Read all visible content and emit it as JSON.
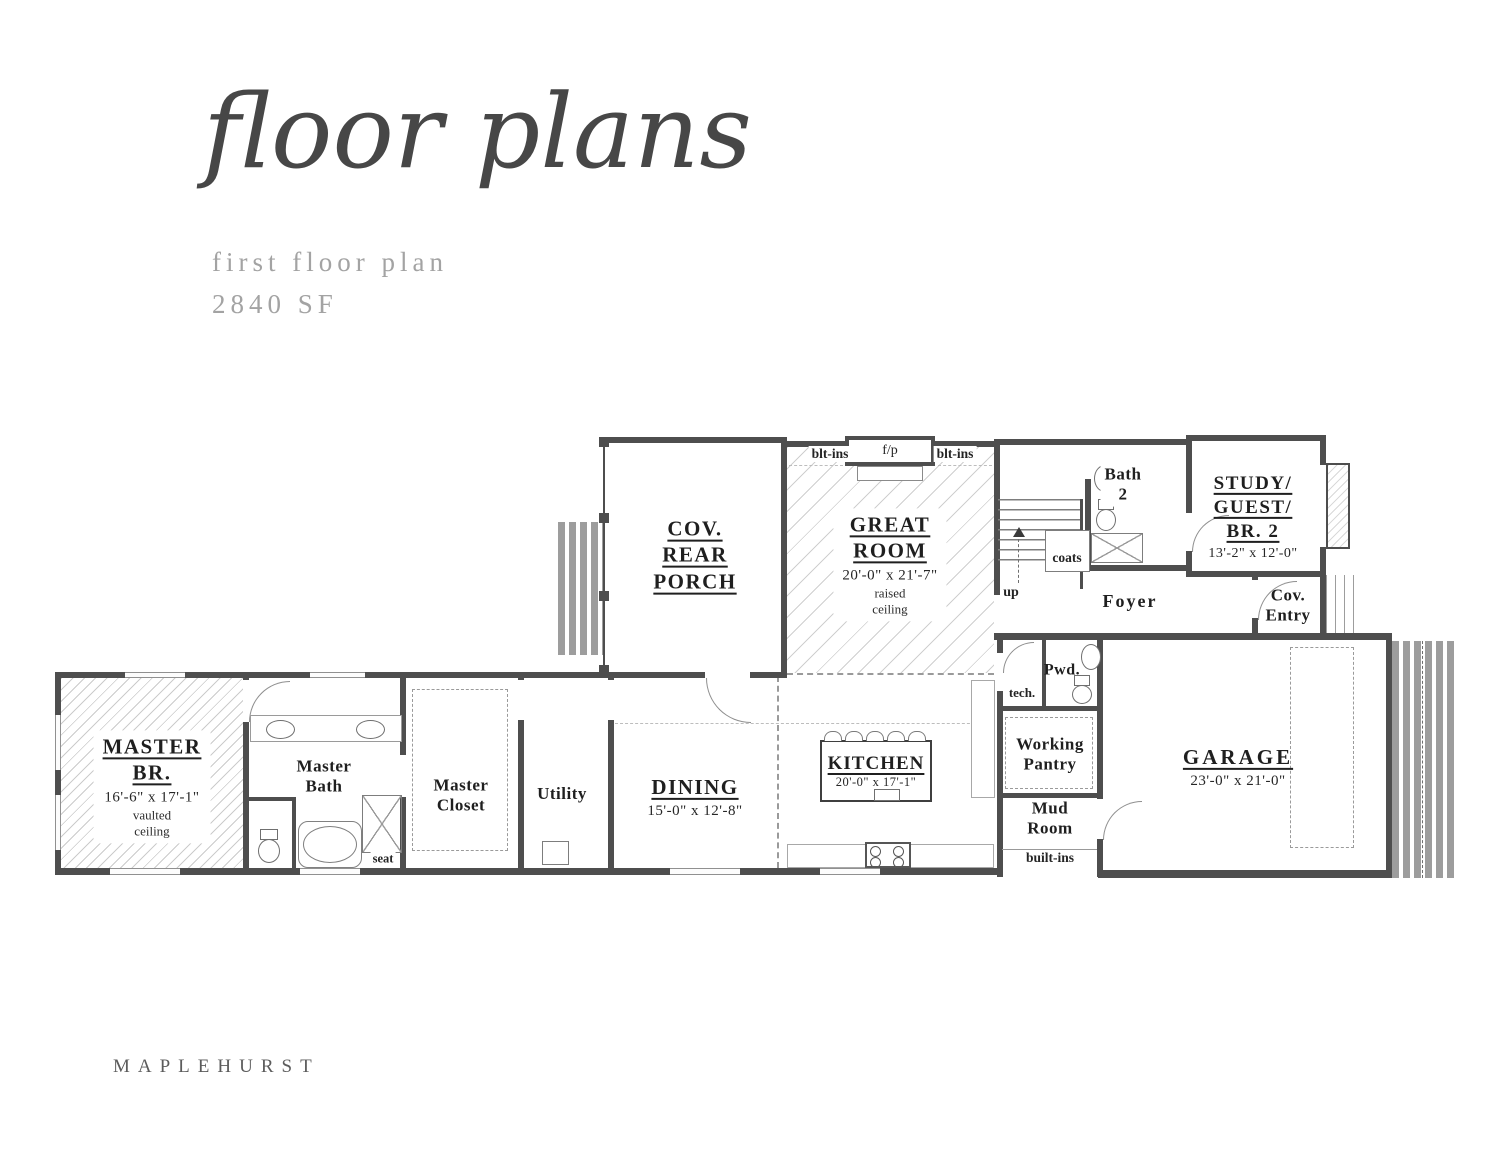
{
  "header": {
    "title": "floor plans",
    "subtitle": "first floor plan",
    "area": "2840 SF"
  },
  "footer": {
    "brand": "MAPLEHURST"
  },
  "rooms": {
    "master_br": {
      "name": "MASTER\nBR.",
      "dims": "16'-6\" x 17'-1\"",
      "note": "vaulted\nceiling"
    },
    "master_bath": {
      "name": "Master\nBath"
    },
    "master_closet": {
      "name": "Master\nCloset"
    },
    "utility": {
      "name": "Utility"
    },
    "dining": {
      "name": "DINING",
      "dims": "15'-0\" x 12'-8\""
    },
    "kitchen": {
      "name": "KITCHEN",
      "dims": "20'-0\" x 17'-1\""
    },
    "great_room": {
      "name": "GREAT\nROOM",
      "dims": "20'-0\" x 21'-7\"",
      "note": "raised\nceiling"
    },
    "cov_rear_porch": {
      "name": "COV.\nREAR\nPORCH"
    },
    "study": {
      "name": "STUDY/\nGUEST/\nBR. 2",
      "dims": "13'-2\" x 12'-0\""
    },
    "bath2": {
      "name": "Bath\n2"
    },
    "foyer": {
      "name": "Foyer"
    },
    "cov_entry": {
      "name": "Cov.\nEntry"
    },
    "pwd": {
      "name": "Pwd."
    },
    "working_pantry": {
      "name": "Working\nPantry"
    },
    "mud_room": {
      "name": "Mud\nRoom"
    },
    "garage": {
      "name": "GARAGE",
      "dims": "23'-0\" x 21'-0\""
    }
  },
  "annotations": {
    "blt_ins_left": "blt-ins",
    "fireplace": "f/p",
    "blt_ins_right": "blt-ins",
    "tech": "tech.",
    "coats": "coats",
    "up": "up",
    "seat": "seat",
    "built_ins": "built-ins"
  },
  "colors": {
    "ink": "#2e2e2e",
    "wall": "#4e4e4e",
    "muted": "#a3a3a3"
  }
}
